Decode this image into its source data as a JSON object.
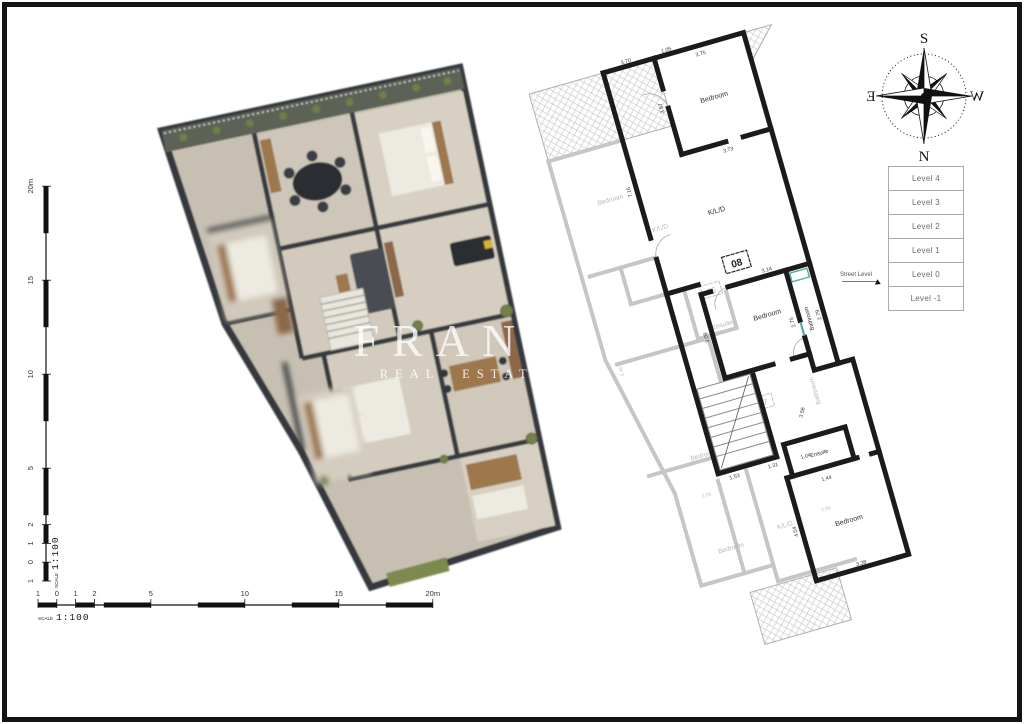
{
  "watermark": {
    "line1": "FRANK",
    "line2": "REAL ESTATE"
  },
  "compass": {
    "top": "S",
    "right": "W",
    "bottom": "N",
    "left": "E"
  },
  "levels": {
    "items": [
      "Level 4",
      "Level 3",
      "Level 2",
      "Level 1",
      "Level 0",
      "Level -1"
    ],
    "street_label": "Street Level"
  },
  "scale_h": {
    "label": "SCALE",
    "ratio": "1:100",
    "ticks": [
      "1",
      "0",
      "1",
      "2",
      "5",
      "10",
      "15",
      "20m"
    ]
  },
  "scale_v": {
    "label": "SCALE",
    "ratio": "1:100",
    "ticks": [
      "1",
      "0",
      "1",
      "2",
      "5",
      "10",
      "15",
      "20m"
    ]
  },
  "plan2d": {
    "badges": [
      "08",
      "06",
      "07"
    ],
    "rooms_active": [
      "Bedroom",
      "K/L/D",
      "Bedroom",
      "Bathroom",
      "Ensuite",
      "Bedroom"
    ],
    "rooms_faded": [
      "Bedroom",
      "K/L/D",
      "Ensuite",
      "Bedroom",
      "Bathroom",
      "Bedroom",
      "K/L/D"
    ],
    "dims_active": [
      "3.70",
      "3.75",
      "3.87",
      "3.73",
      "1.05",
      "7.16",
      "3.14",
      "3.08",
      "2.75",
      "2.79",
      "3.56",
      "1.53",
      "1.31",
      "1.04",
      "1.44",
      "4.54",
      "3.38"
    ],
    "dims_faded": [
      "2.05",
      "2.06",
      "3.18",
      "2.40"
    ],
    "colors": {
      "wall_active": "#1b1b1b",
      "wall_faded": "#c6c6c6",
      "accent_teal": "#5aa8a1"
    }
  },
  "plan3d": {
    "colors": {
      "wall": "#383b40",
      "floor": "#cfc8ba",
      "wood": "#9e774e",
      "greenery": "#72804a",
      "sofa": "#4a4e54"
    }
  }
}
